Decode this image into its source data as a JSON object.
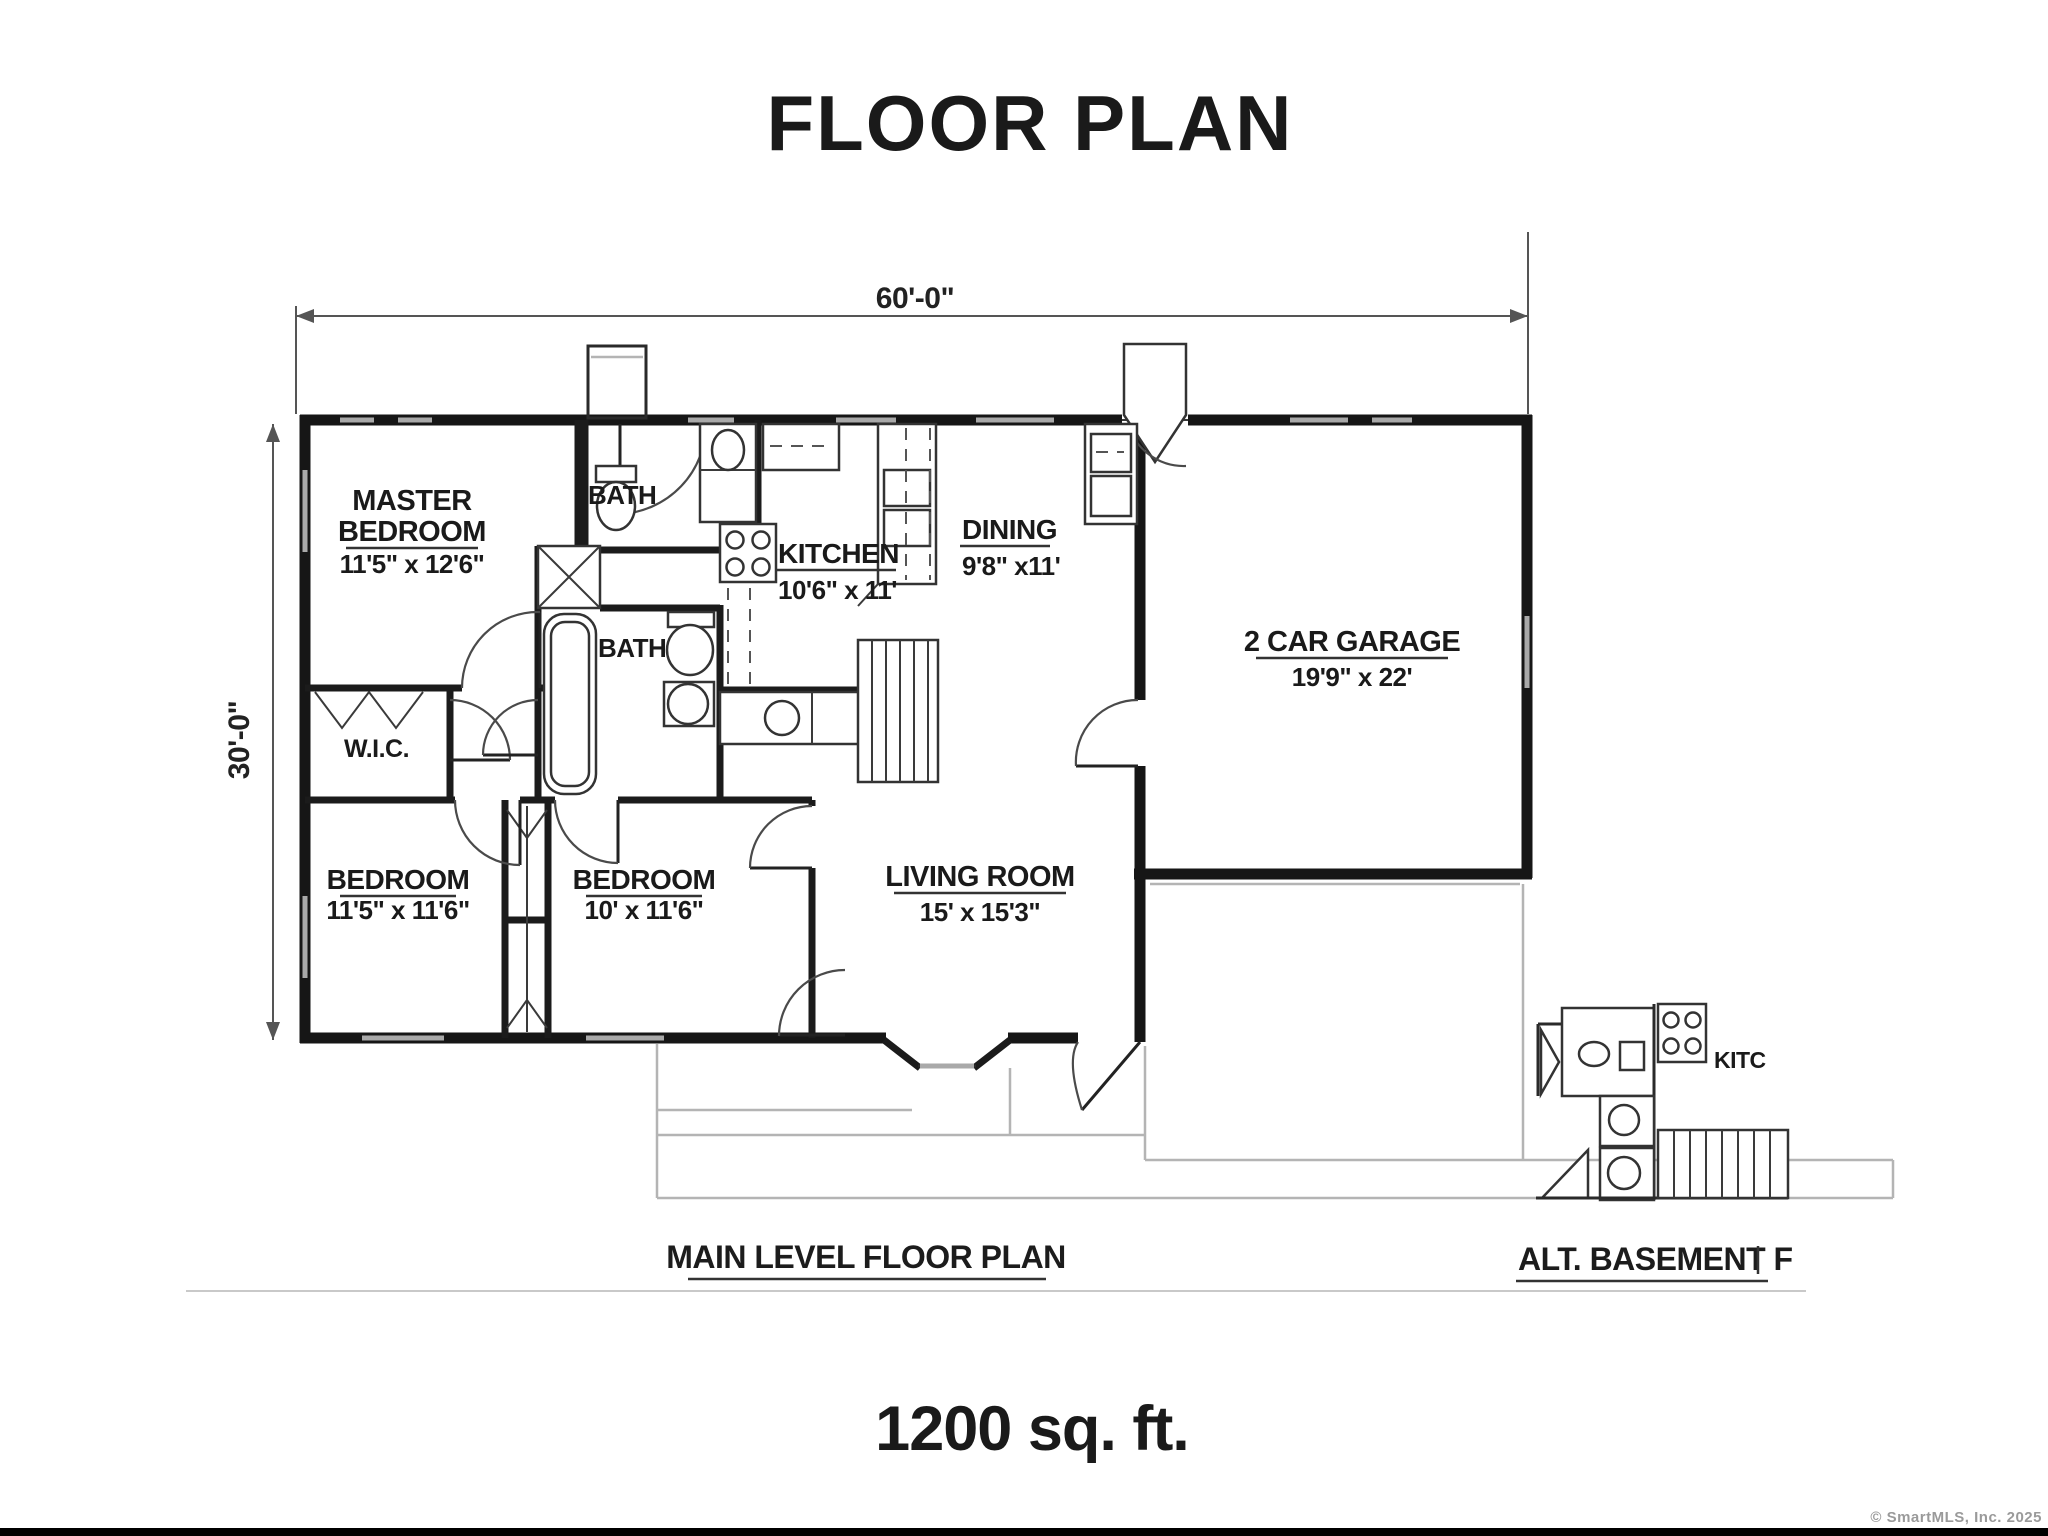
{
  "title": "FLOOR PLAN",
  "area_total": "1200 sq. ft.",
  "credit": "© SmartMLS, Inc. 2025",
  "main_plan": {
    "caption": "MAIN LEVEL FLOOR PLAN",
    "dim_width": "60'-0\"",
    "dim_height": "30'-0\"",
    "rooms": {
      "master_bedroom": {
        "name_line1": "MASTER",
        "name_line2": "BEDROOM",
        "size": "11'5\" x 12'6\""
      },
      "bath_upper": {
        "name": "BATH"
      },
      "bath_lower": {
        "name": "BATH"
      },
      "kitchen": {
        "name": "KITCHEN",
        "size": "10'6\" x 11'"
      },
      "dining": {
        "name": "DINING",
        "size": "9'8\" x11'"
      },
      "garage": {
        "name": "2 CAR GARAGE",
        "size": "19'9\" x 22'"
      },
      "wic": {
        "name": "W.I.C."
      },
      "bedroom_left": {
        "name": "BEDROOM",
        "size": "11'5\" x 11'6\""
      },
      "bedroom_middle": {
        "name": "BEDROOM",
        "size": "10' x 11'6\""
      },
      "living_room": {
        "name": "LIVING ROOM",
        "size": "15' x 15'3\""
      }
    }
  },
  "basement_plan": {
    "caption": "ALT. BASEMENT F",
    "kitchen_label": "KITC"
  }
}
